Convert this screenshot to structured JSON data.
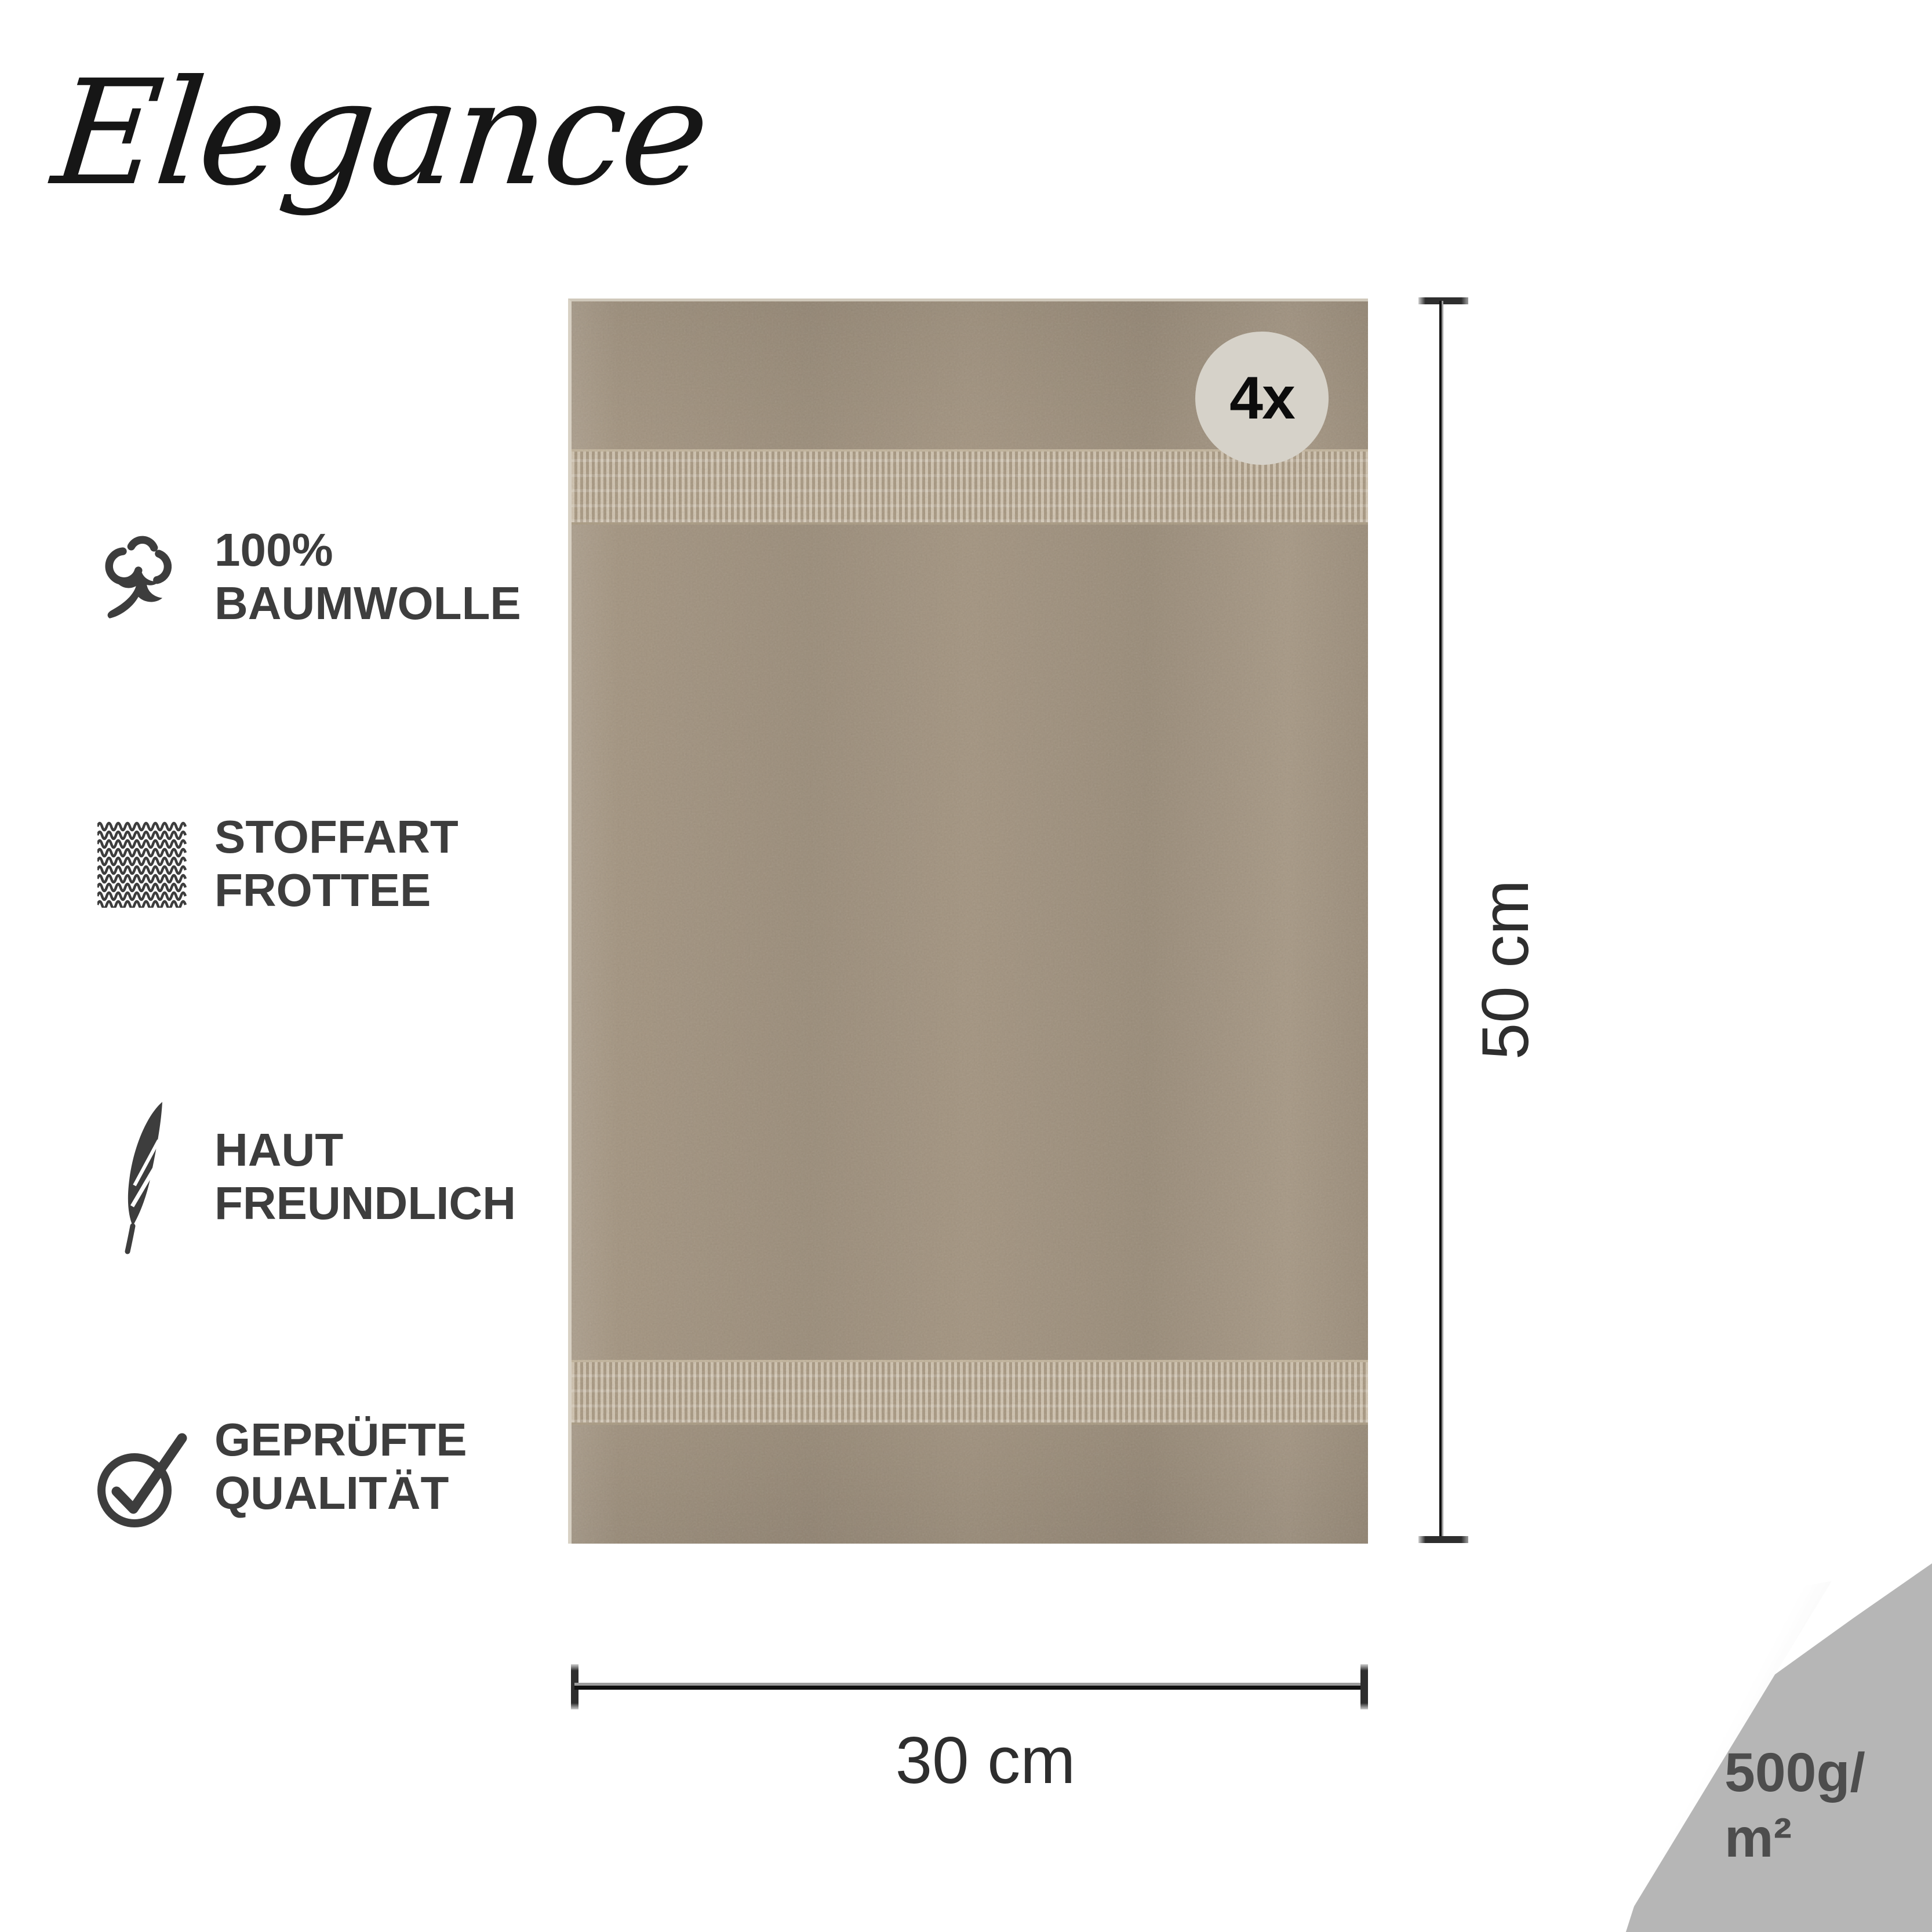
{
  "brand": {
    "name": "Elegance"
  },
  "features": [
    {
      "icon": "cotton-flower-icon",
      "line1": "100%",
      "line2": "BAUMWOLLE"
    },
    {
      "icon": "fabric-texture-icon",
      "line1": "STOFFART",
      "line2": "FROTTEE"
    },
    {
      "icon": "feather-icon",
      "line1": "HAUT",
      "line2": "FREUNDLICH"
    },
    {
      "icon": "check-circle-icon",
      "line1": "GEPRÜFTE",
      "line2": "QUALITÄT"
    }
  ],
  "towel": {
    "quantity_badge": "4x",
    "height_label": "50 cm",
    "width_label": "30 cm",
    "color_hex": "#a49581",
    "band_color_hex": "#b2a38c",
    "badge_bg_hex": "#d6d2c9"
  },
  "corner": {
    "weight_line1": "500g/",
    "weight_line2": "m²",
    "bg_hex": "#b6b6b6",
    "text_color_hex": "#4d4d4d"
  },
  "colors": {
    "feature_text": "#3d3d3d",
    "dimension_text": "#2e2e2e",
    "logo_text": "#161616"
  }
}
